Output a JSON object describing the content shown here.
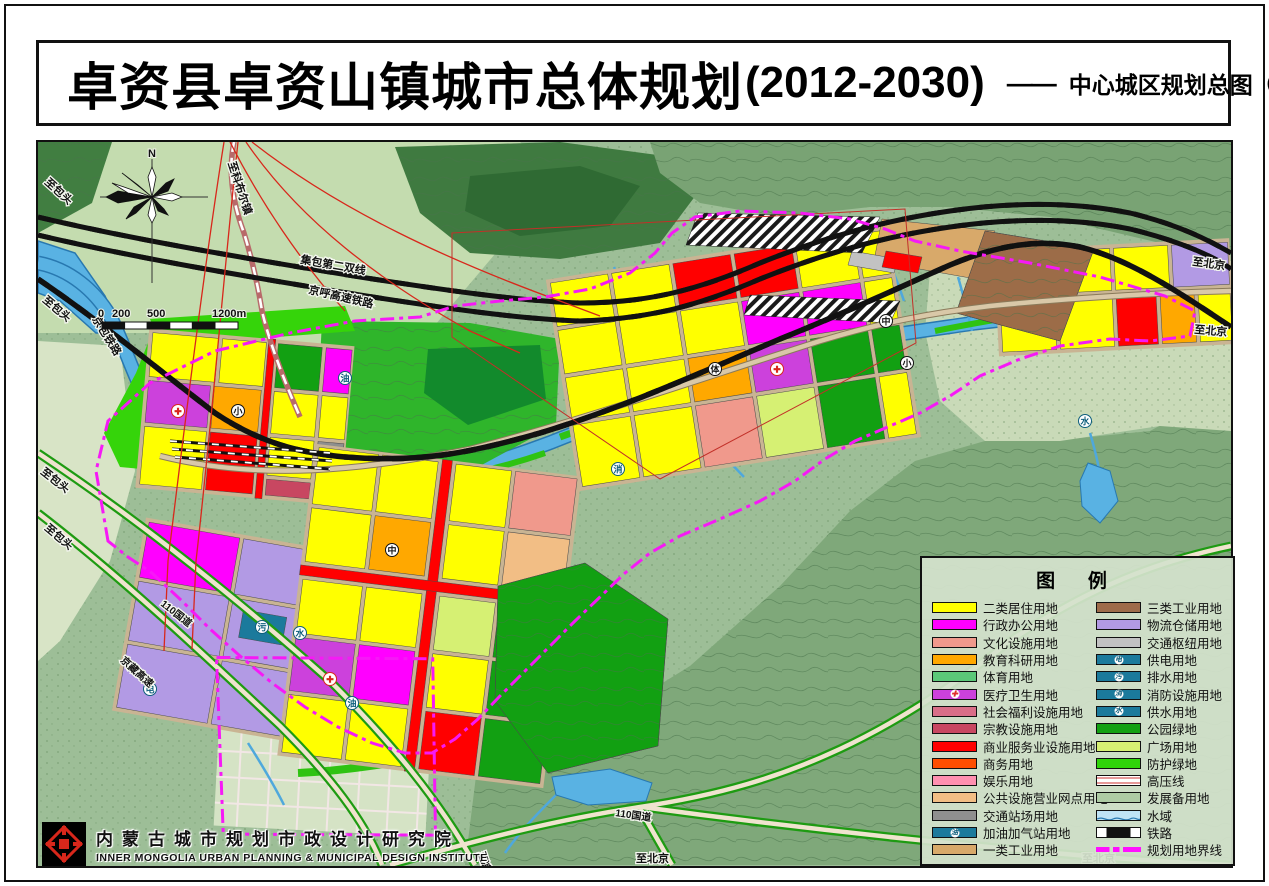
{
  "title": {
    "main": "卓资县卓资山镇城市总体规划",
    "years": "(2012-2030)",
    "separator": "——",
    "sub": "中心城区规划总图",
    "sub_year": "（2030年）"
  },
  "compass": {
    "north": "N"
  },
  "scale_bar": {
    "ticks": [
      "0",
      "200",
      "500",
      "1200m"
    ]
  },
  "legend": {
    "title": "图  例",
    "left": [
      {
        "label": "二类居住用地",
        "color": "#FFFF00"
      },
      {
        "label": "行政办公用地",
        "color": "#FF00FF"
      },
      {
        "label": "文化设施用地",
        "color": "#F0998C"
      },
      {
        "label": "教育科研用地",
        "color": "#FFA800"
      },
      {
        "label": "体育用地",
        "color": "#5BC878"
      },
      {
        "label": "医疗卫生用地",
        "color": "#CC41DC",
        "icon": "✚"
      },
      {
        "label": "社会福利设施用地",
        "color": "#D96E88"
      },
      {
        "label": "宗教设施用地",
        "color": "#C84761"
      },
      {
        "label": "商业服务业设施用地",
        "color": "#FF0000"
      },
      {
        "label": "商务用地",
        "color": "#FF4E00"
      },
      {
        "label": "娱乐用地",
        "color": "#FF8FB0"
      },
      {
        "label": "公共设施营业网点用地",
        "color": "#F2BE85"
      },
      {
        "label": "交通站场用地",
        "color": "#8F8F8F"
      },
      {
        "label": "加油加气站用地",
        "color": "#1B7A9C",
        "icon": "油"
      },
      {
        "label": "一类工业用地",
        "color": "#D8A96A"
      }
    ],
    "right": [
      {
        "label": "三类工业用地",
        "color": "#9E6B4A"
      },
      {
        "label": "物流仓储用地",
        "color": "#B29AE4"
      },
      {
        "label": "交通枢纽用地",
        "color": "#C2C2C2"
      },
      {
        "label": "供电用地",
        "color": "#1B7A9C",
        "icon": "电"
      },
      {
        "label": "排水用地",
        "color": "#1B7A9C",
        "icon": "污"
      },
      {
        "label": "消防设施用地",
        "color": "#1B7A9C",
        "icon": "消"
      },
      {
        "label": "供水用地",
        "color": "#1B7A9C",
        "icon": "水"
      },
      {
        "label": "公园绿地",
        "color": "#12A012"
      },
      {
        "label": "广场用地",
        "color": "#D6F073"
      },
      {
        "label": "防护绿地",
        "color": "#2FD40A"
      },
      {
        "label": "高压线",
        "color": "#CF3333"
      },
      {
        "label": "发展备用地",
        "color": "#AECBA4"
      },
      {
        "label": "水域",
        "color": "#59B2E3"
      },
      {
        "label": "铁路",
        "color": "#111111"
      },
      {
        "label": "规划用地界线",
        "color": "#FF10FF"
      }
    ]
  },
  "map_labels": {
    "to_baotou": "至包头",
    "to_beijing": "至北京",
    "to_kebuer": "至科布尔镇",
    "to_liangcheng": "至凉城",
    "jingbao_railway": "京包铁路",
    "jibao_line": "集包第二双线",
    "jinghu_hsr": "京呼高速铁路",
    "g110": "110国道",
    "jingzang_expwy": "京藏高速"
  },
  "markers": {
    "oil": "油",
    "sewage": "污",
    "power": "电",
    "water": "水",
    "fire": "消",
    "school_small": "小",
    "school_mid": "中",
    "sports": "体",
    "hospital": "✚"
  },
  "institute": {
    "cn": "内蒙古城市规划市政设计研究院",
    "en": "INNER MONGOLIA URBAN PLANNING & MUNICIPAL DESIGN INSTITUTE"
  }
}
